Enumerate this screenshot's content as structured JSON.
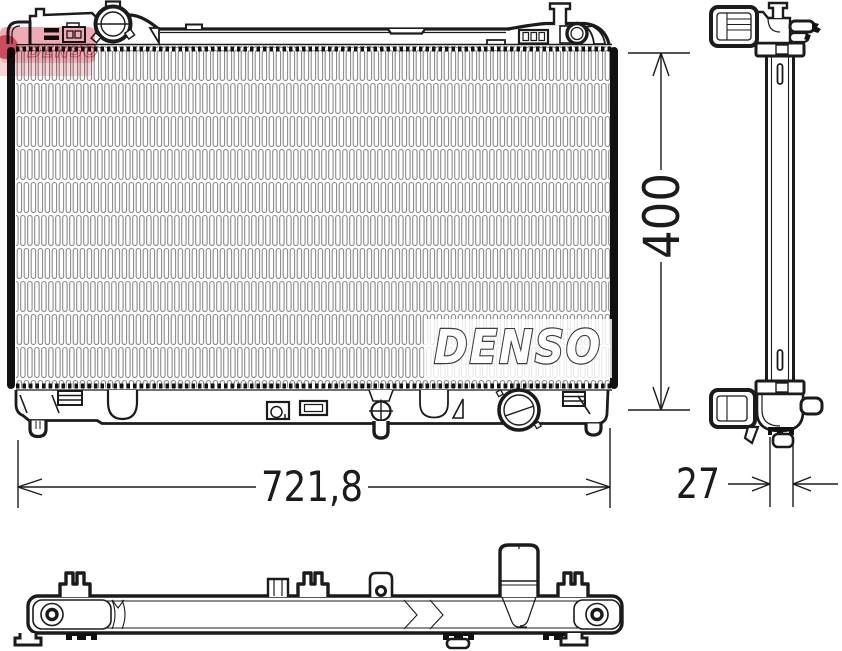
{
  "drawing": {
    "brand_logo": "DENSO",
    "watermark_text": "DENSO",
    "dimensions": {
      "height": "400",
      "width": "721,8",
      "depth": "27"
    }
  },
  "colors": {
    "line": "#1b1b1b",
    "fin_stroke": "#8a8a8a",
    "paper": "#ffffff",
    "watermark_pink": "#e5808d",
    "watermark_red": "#c2344d",
    "logo_outline": "#3d3d3d"
  }
}
